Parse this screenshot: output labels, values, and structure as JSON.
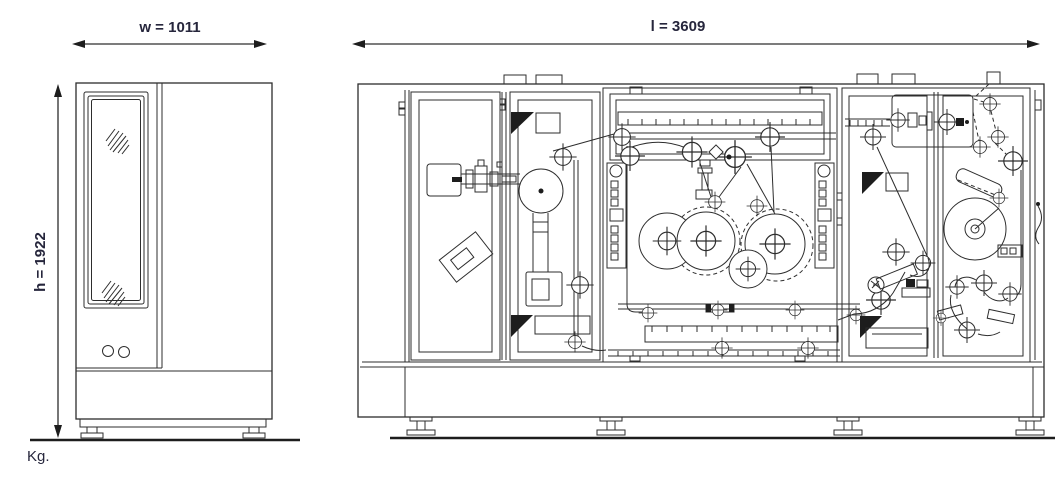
{
  "page": {
    "background": "#ffffff"
  },
  "drawing": {
    "line_color": "#2d2d2d",
    "label_color": "#26263c",
    "labels": {
      "width": "w = 1011",
      "length": "l = 3609",
      "height": "h = 1922",
      "weight_unit": "Kg."
    },
    "dimensions_mm": {
      "width": 1011,
      "length": 3609,
      "height": 1922
    },
    "views": [
      {
        "id": "side-elevation"
      },
      {
        "id": "front-elevation"
      }
    ]
  }
}
